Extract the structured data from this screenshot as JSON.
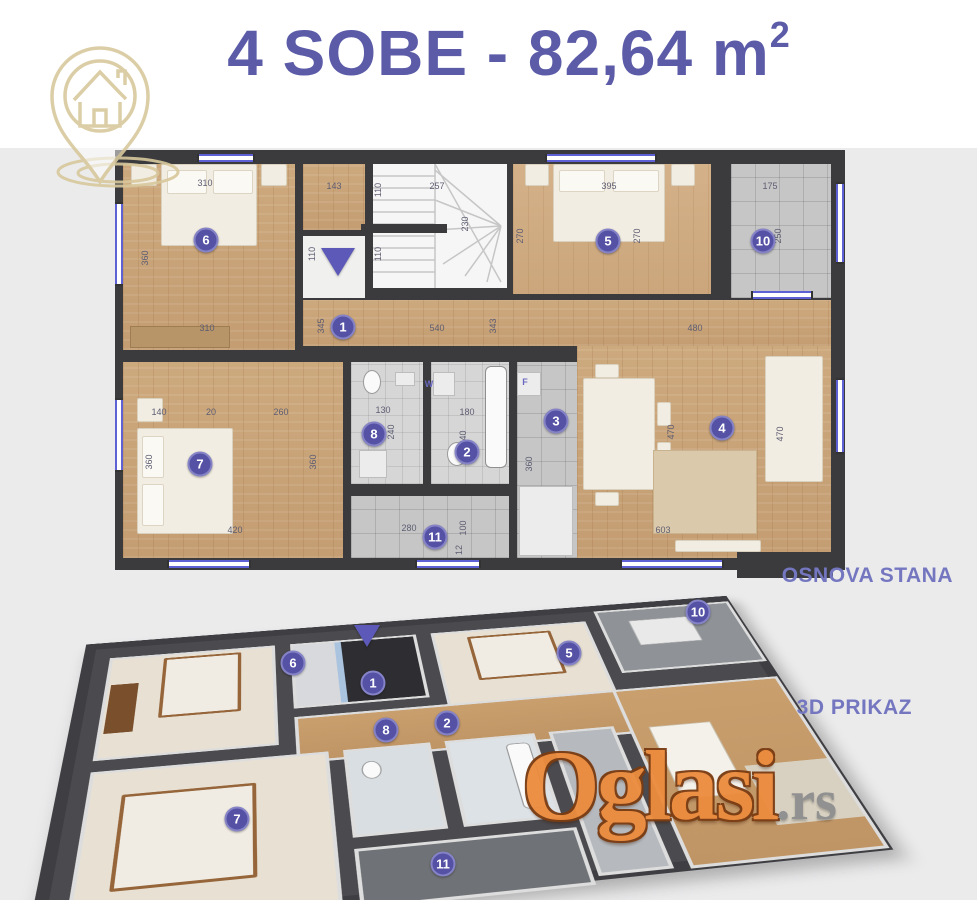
{
  "colors": {
    "purple": "#5b5ba8",
    "caption": "#7477c0",
    "marker-bg": "#5552a6",
    "marker-ring": "#8583c6",
    "gold": "#d8c89c",
    "wm-orange": "#ec8c3e",
    "wm-gray": "#8f8f8f",
    "band": "#ebebec",
    "winblue": "#5e60d6",
    "wall": "#3b3b3d"
  },
  "header": {
    "title": "4 SOBE - 82,64 m",
    "title_sup": "2"
  },
  "logo": {
    "label": "house-location-pin"
  },
  "plan2d": {
    "caption": "OSNOVA STANA",
    "rooms": [
      {
        "n": "1",
        "x": 228,
        "y": 177
      },
      {
        "n": "2",
        "x": 352,
        "y": 302
      },
      {
        "n": "3",
        "x": 441,
        "y": 271
      },
      {
        "n": "4",
        "x": 607,
        "y": 278
      },
      {
        "n": "5",
        "x": 493,
        "y": 91
      },
      {
        "n": "6",
        "x": 91,
        "y": 90
      },
      {
        "n": "7",
        "x": 85,
        "y": 314
      },
      {
        "n": "8",
        "x": 259,
        "y": 284
      },
      {
        "n": "10",
        "x": 648,
        "y": 91
      },
      {
        "n": "11",
        "x": 320,
        "y": 387
      }
    ],
    "dims": [
      {
        "t": "310",
        "x": 90,
        "y": 33
      },
      {
        "t": "360",
        "x": 30,
        "y": 108,
        "v": 1
      },
      {
        "t": "143",
        "x": 219,
        "y": 36
      },
      {
        "t": "110",
        "x": 263,
        "y": 40,
        "v": 1
      },
      {
        "t": "257",
        "x": 322,
        "y": 36
      },
      {
        "t": "230",
        "x": 350,
        "y": 74,
        "v": 1
      },
      {
        "t": "110",
        "x": 197,
        "y": 104,
        "v": 1
      },
      {
        "t": "110",
        "x": 263,
        "y": 104,
        "v": 1
      },
      {
        "t": "395",
        "x": 494,
        "y": 36
      },
      {
        "t": "270",
        "x": 405,
        "y": 86,
        "v": 1
      },
      {
        "t": "270",
        "x": 522,
        "y": 86,
        "v": 1
      },
      {
        "t": "175",
        "x": 655,
        "y": 36
      },
      {
        "t": "250",
        "x": 663,
        "y": 86,
        "v": 1
      },
      {
        "t": "310",
        "x": 92,
        "y": 178
      },
      {
        "t": "345",
        "x": 206,
        "y": 176,
        "v": 1
      },
      {
        "t": "540",
        "x": 322,
        "y": 178
      },
      {
        "t": "343",
        "x": 378,
        "y": 176,
        "v": 1
      },
      {
        "t": "480",
        "x": 580,
        "y": 178
      },
      {
        "t": "140",
        "x": 44,
        "y": 262
      },
      {
        "t": "20",
        "x": 96,
        "y": 262
      },
      {
        "t": "260",
        "x": 166,
        "y": 262
      },
      {
        "t": "360",
        "x": 34,
        "y": 312,
        "v": 1
      },
      {
        "t": "360",
        "x": 198,
        "y": 312,
        "v": 1
      },
      {
        "t": "420",
        "x": 120,
        "y": 380
      },
      {
        "t": "130",
        "x": 268,
        "y": 260
      },
      {
        "t": "240",
        "x": 276,
        "y": 282,
        "v": 1
      },
      {
        "t": "180",
        "x": 352,
        "y": 262
      },
      {
        "t": "240",
        "x": 348,
        "y": 288,
        "v": 1
      },
      {
        "t": "360",
        "x": 414,
        "y": 314,
        "v": 1
      },
      {
        "t": "470",
        "x": 556,
        "y": 282,
        "v": 1
      },
      {
        "t": "470",
        "x": 665,
        "y": 284,
        "v": 1
      },
      {
        "t": "603",
        "x": 548,
        "y": 380
      },
      {
        "t": "280",
        "x": 294,
        "y": 378
      },
      {
        "t": "100",
        "x": 348,
        "y": 378,
        "v": 1
      },
      {
        "t": "12",
        "x": 344,
        "y": 400,
        "v": 1
      }
    ],
    "appliances": [
      {
        "t": "W",
        "x": 314,
        "y": 234
      },
      {
        "t": "F",
        "x": 410,
        "y": 232
      }
    ]
  },
  "plan3d": {
    "caption": "3D PRIKAZ",
    "rooms": [
      {
        "n": "6",
        "x": 203,
        "y": 78
      },
      {
        "n": "1",
        "x": 283,
        "y": 98
      },
      {
        "n": "5",
        "x": 479,
        "y": 68
      },
      {
        "n": "10",
        "x": 608,
        "y": 27
      },
      {
        "n": "8",
        "x": 296,
        "y": 145
      },
      {
        "n": "2",
        "x": 357,
        "y": 138
      },
      {
        "n": "7",
        "x": 147,
        "y": 234
      },
      {
        "n": "11",
        "x": 353,
        "y": 279
      }
    ]
  },
  "watermark": {
    "name": "Oglasi",
    "tld": ".rs"
  }
}
